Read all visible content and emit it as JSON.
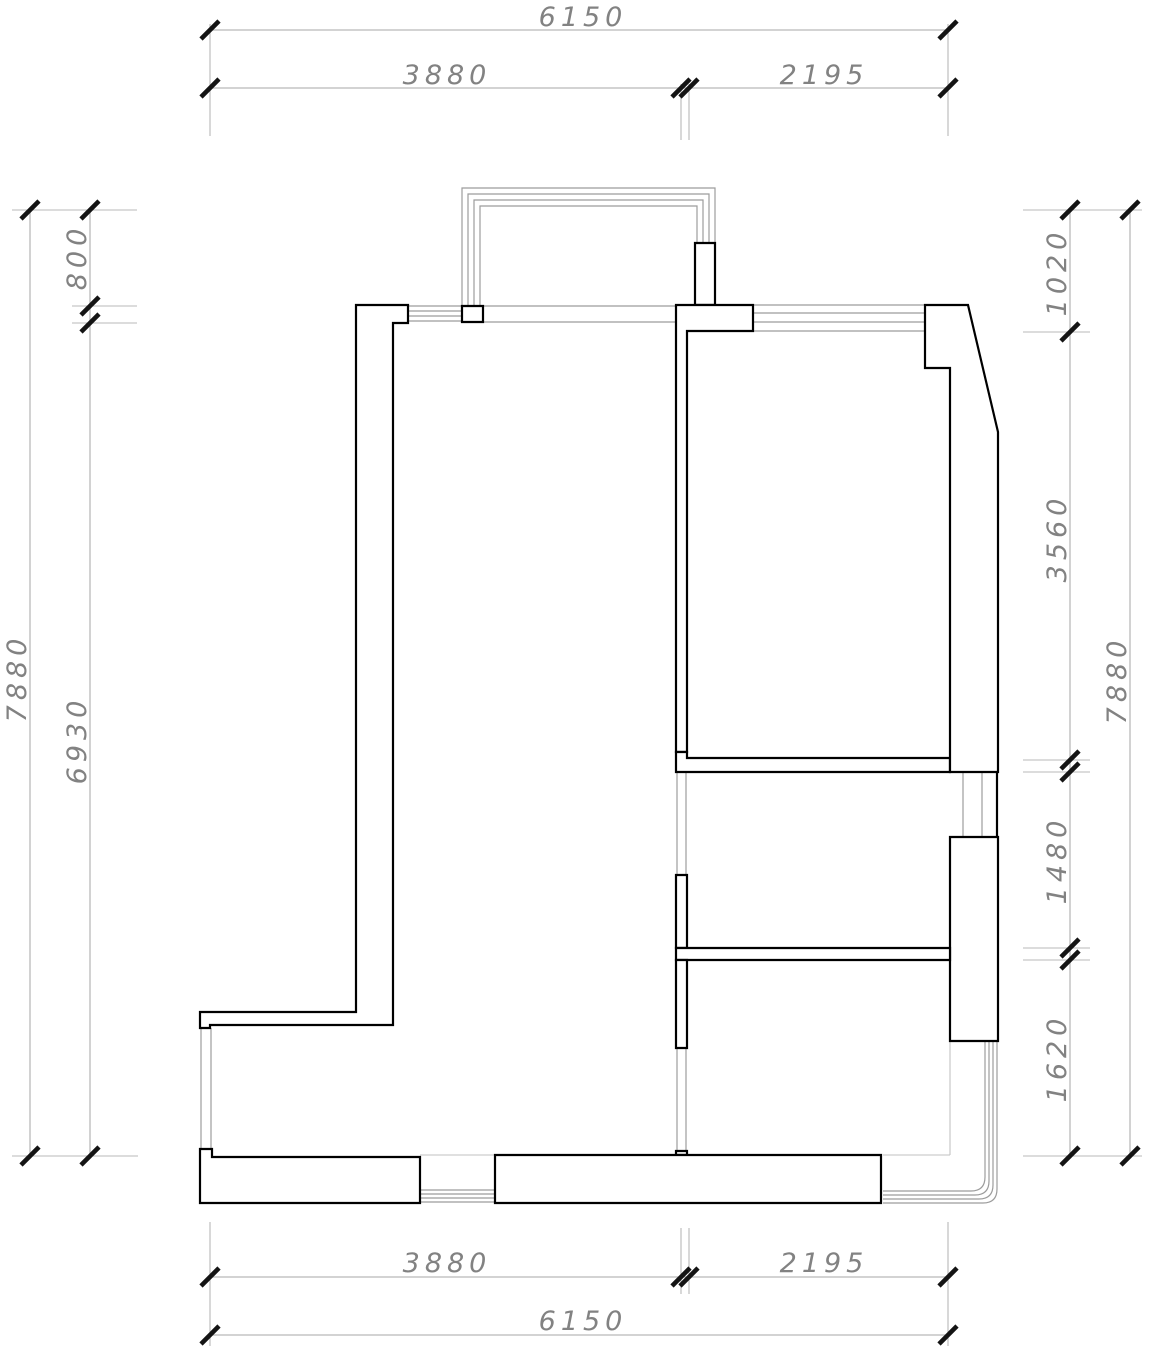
{
  "document": {
    "kind": "architectural floor plan drawing",
    "units_note": "mm"
  },
  "colors": {
    "background": "#ffffff",
    "wall_line": "#000000",
    "thin_line": "#9c9c9c",
    "thin_line_light": "#c2c2c2",
    "dim_line": "#b9b9b9",
    "tick": "#141414",
    "dim_text": "#828282"
  },
  "dimensions": {
    "top": {
      "overall": "6150",
      "segment_left": "3880",
      "segment_right": "2195"
    },
    "bottom": {
      "overall": "6150",
      "segment_left": "3880",
      "segment_right": "2195"
    },
    "left": {
      "overall": "7880",
      "segment_top": "800",
      "segment_bottom": "6930"
    },
    "right": {
      "overall": "7880",
      "segment_1": "1020",
      "segment_2": "3560",
      "segment_3": "1480",
      "segment_4": "1620"
    }
  }
}
